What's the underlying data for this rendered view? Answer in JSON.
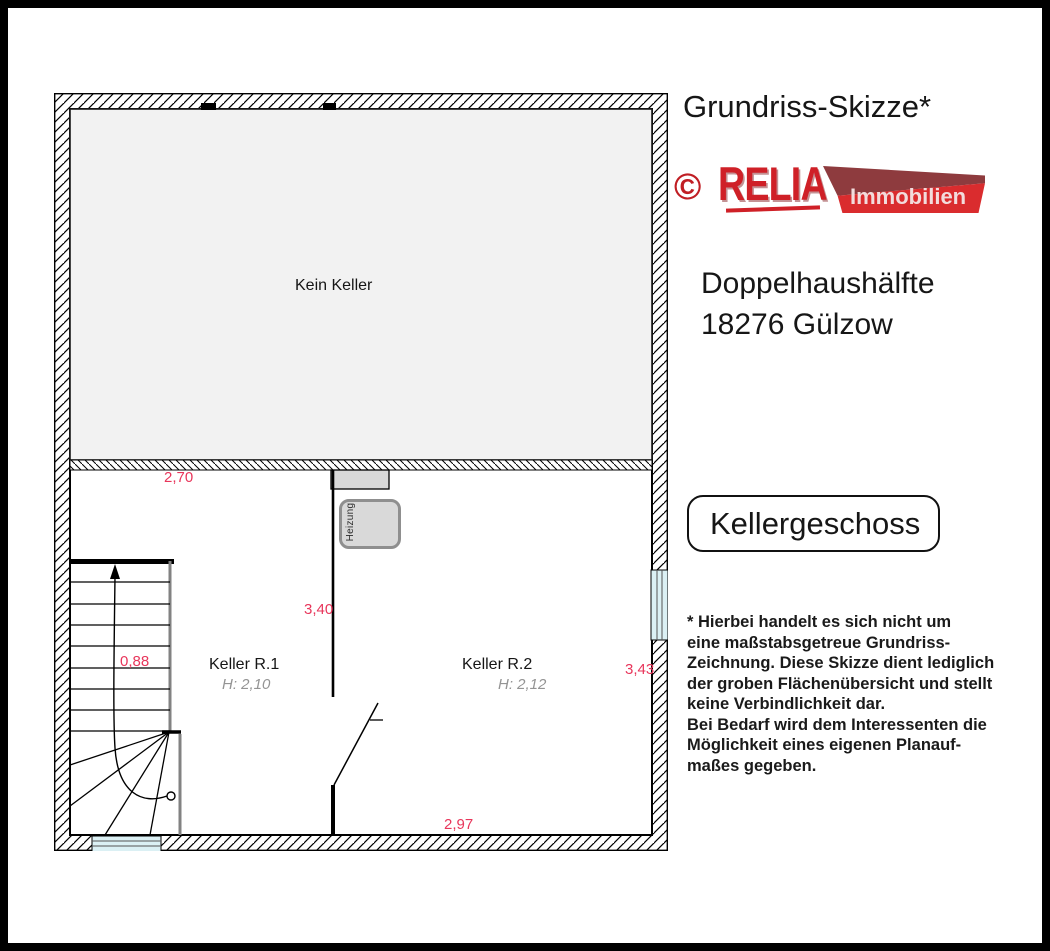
{
  "plan": {
    "areas": {
      "kein_keller": "Kein Keller",
      "keller_r1": {
        "name": "Keller R.1",
        "height": "H: 2,10"
      },
      "keller_r2": {
        "name": "Keller R.2",
        "height": "H: 2,12"
      },
      "heizung": "Heizung"
    },
    "dimensions": {
      "top_width": "2,70",
      "r2_height_dim": "3,40",
      "stair_width": "0,88",
      "right_depth": "3,43",
      "bottom_width": "2,97"
    }
  },
  "panel": {
    "title": "Grundriss-Skizze*",
    "logo": {
      "copyright": "©",
      "brand": "RELIA",
      "suffix": "Immobilien"
    },
    "property": {
      "line1": "Doppelhaushälfte",
      "line2": "18276 Gülzow"
    },
    "floor_label": "Kellergeschoss",
    "disclaimer": "* Hierbei handelt es sich nicht um\neine maßstabsgetreue Grundriss-\nZeichnung. Diese Skizze dient lediglich\nder groben Flächenübersicht und stellt\nkeine Verbindlichkeit dar.\nBei Bedarf wird dem Interessenten die\nMöglichkeit eines eigenen Planauf-\nmaßes gegeben."
  },
  "colors": {
    "dimension_red": "#e8365b",
    "brand_red": "#cf2027",
    "banner_maroon": "#8e3b3e",
    "banner_red": "#da2c2e",
    "no_basement_gray": "#f2f2f2",
    "window_blue": "#dbf0f4",
    "fixture_gray": "#d9d9d9"
  }
}
